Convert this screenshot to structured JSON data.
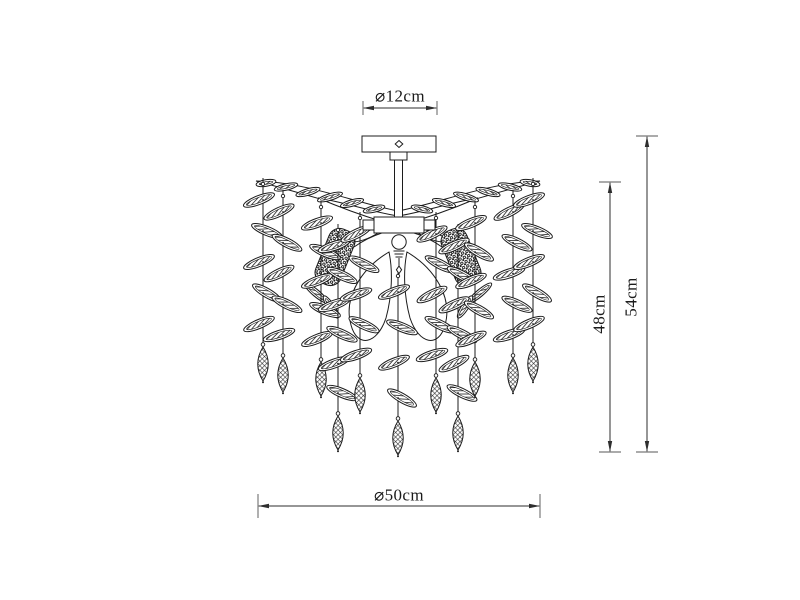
{
  "colors": {
    "background": "#ffffff",
    "line": "#1c1c1c",
    "dim": "#2e2e2e",
    "tick": "#8f8f8f",
    "text": "#1b1b1b"
  },
  "dimensions": {
    "canopy_diameter": {
      "label": "⌀12cm",
      "value_cm": 12
    },
    "drop_height": {
      "label": "48cm",
      "value_cm": 48
    },
    "total_height": {
      "label": "54cm",
      "value_cm": 54
    },
    "spread_diameter": {
      "label": "⌀50cm",
      "value_cm": 50
    }
  },
  "diagram": {
    "dim_lines": {
      "top": {
        "y": 108,
        "x1": 363,
        "x2": 437,
        "tick_half": 7
      },
      "bottom": {
        "y": 506,
        "x1": 258,
        "x2": 540,
        "tick_half": 12
      },
      "inner": {
        "x": 610,
        "y1": 182,
        "y2": 452,
        "tick_half": 11
      },
      "outer": {
        "x": 647,
        "y1": 136,
        "y2": 452,
        "tick_half": 11
      }
    },
    "canopy": {
      "x": 362,
      "y": 136,
      "w": 74,
      "h": 16
    },
    "connector": {
      "x": 390,
      "y": 152,
      "w": 17,
      "h": 8
    },
    "stem": {
      "x": 394.5,
      "y": 160,
      "w": 8,
      "h": 58
    },
    "hub": {
      "x": 374,
      "y": 217,
      "w": 50,
      "h": 16
    },
    "hub_tabs": [
      [
        363,
        220,
        11,
        10
      ],
      [
        424,
        220,
        11,
        10
      ]
    ],
    "socket": {
      "cx": 399,
      "cy": 242,
      "r": 7.2
    },
    "wing": {
      "main": "M398,211 C356,203 306,182 256,181 C295,191 342,206 398,221 Z",
      "inner": "M398,216 C372,212 344,202 318,198 C346,210 372,219 398,226 Z",
      "links": [
        "M383,227 Q362,231 346,240",
        "M385,232 Q368,237 354,247",
        "M378,233 Q362,243 348,242"
      ],
      "feathers": [
        [
          266,
          183,
          -10,
          20
        ],
        [
          286,
          187,
          -13,
          24
        ],
        [
          308,
          192,
          -16,
          25
        ],
        [
          330,
          197,
          -17,
          26
        ],
        [
          352,
          203,
          -16,
          24
        ],
        [
          374,
          209,
          -13,
          22
        ]
      ]
    },
    "cluster": {
      "cx": 335,
      "cy": 257,
      "w": 27,
      "h": 58,
      "angle": 22,
      "sprays": [
        [
          316,
          293,
          40,
          30
        ],
        [
          331,
          307,
          57,
          26
        ]
      ]
    },
    "teardrop": "M389,252 C362,268 343,297 351,325 C357,348 377,345 386,318 C392,296 393,271 389,252 Z",
    "strings": [
      {
        "x": 263,
        "top": 184,
        "pendant_y": 364
      },
      {
        "x": 283,
        "top": 196,
        "pendant_y": 375
      },
      {
        "x": 321,
        "top": 207,
        "pendant_y": 379
      },
      {
        "x": 338,
        "top": 230,
        "pendant_y": 433
      },
      {
        "x": 360,
        "top": 218,
        "pendant_y": 395
      },
      {
        "x": 398,
        "top": 276,
        "pendant_y": 438
      },
      {
        "x": 436,
        "top": 218,
        "pendant_y": 395
      },
      {
        "x": 458,
        "top": 230,
        "pendant_y": 433
      },
      {
        "x": 475,
        "top": 207,
        "pendant_y": 379
      },
      {
        "x": 513,
        "top": 196,
        "pendant_y": 375
      },
      {
        "x": 533,
        "top": 184,
        "pendant_y": 364
      }
    ]
  }
}
